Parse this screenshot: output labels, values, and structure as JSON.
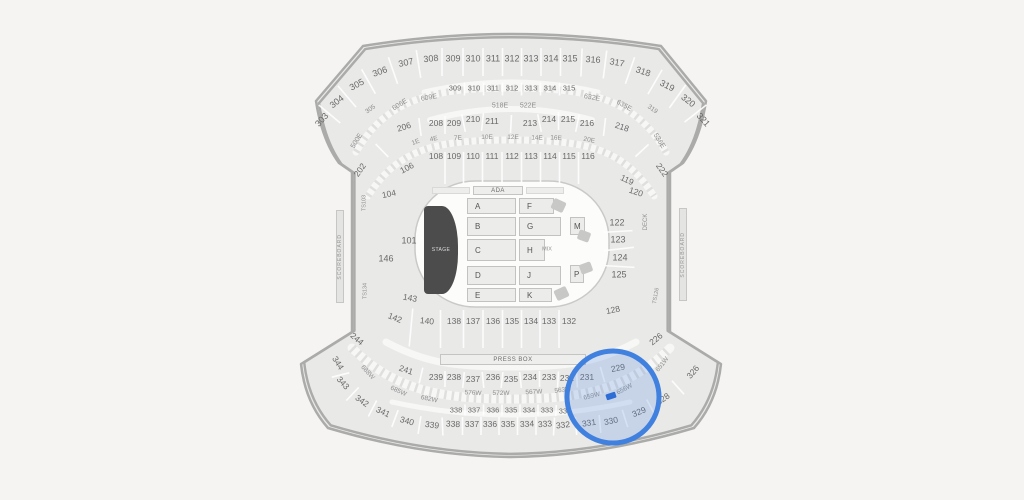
{
  "colors": {
    "background": "#f5f4f2",
    "section_fill": "#e9e9e8",
    "outline": "#ababa9",
    "walkway": "#f7f7f5",
    "label": "#696969",
    "label_dim": "#8f8f8f",
    "field_fill": "#fcfcfb",
    "stage_fill": "#4c4c4c",
    "highlight_stroke": "#4080df",
    "highlight_fill": "rgba(77,131,222,0.22)",
    "marker_fill": "#2e6cd6"
  },
  "map": {
    "stage_label": "STAGE",
    "press_box_label": "PRESS BOX",
    "ada_label": "ADA",
    "scoreboard_label": "SCOREBOARD",
    "floor": {
      "A": "A",
      "B": "B",
      "C": "C",
      "D": "D",
      "E": "E",
      "F": "F",
      "G": "G",
      "H": "H",
      "J": "J",
      "K": "K",
      "M": "M",
      "P": "P"
    },
    "labels": [
      {
        "t": "303",
        "x": 322,
        "y": 120,
        "r": -48,
        "s": 9,
        "row": "o3t"
      },
      {
        "t": "304",
        "x": 337,
        "y": 102,
        "r": -38,
        "s": 9,
        "row": "o3t"
      },
      {
        "t": "305",
        "x": 357,
        "y": 85,
        "r": -28,
        "s": 9,
        "row": "o3t"
      },
      {
        "t": "306",
        "x": 380,
        "y": 72,
        "r": -20,
        "s": 9,
        "row": "o3t"
      },
      {
        "t": "307",
        "x": 406,
        "y": 63,
        "r": -12,
        "s": 9,
        "row": "o3t"
      },
      {
        "t": "308",
        "x": 431,
        "y": 59,
        "r": -6,
        "s": 9,
        "row": "o3t"
      },
      {
        "t": "309",
        "x": 453,
        "y": 59,
        "s": 9,
        "row": "o3t"
      },
      {
        "t": "310",
        "x": 473,
        "y": 59,
        "s": 9,
        "row": "o3t"
      },
      {
        "t": "311",
        "x": 493,
        "y": 59,
        "s": 9,
        "row": "o3t"
      },
      {
        "t": "312",
        "x": 512,
        "y": 59,
        "s": 9,
        "row": "o3t"
      },
      {
        "t": "313",
        "x": 531,
        "y": 59,
        "s": 9,
        "row": "o3t"
      },
      {
        "t": "314",
        "x": 551,
        "y": 59,
        "s": 9,
        "row": "o3t"
      },
      {
        "t": "315",
        "x": 570,
        "y": 59,
        "s": 9,
        "row": "o3t"
      },
      {
        "t": "316",
        "x": 593,
        "y": 60,
        "r": 4,
        "s": 9,
        "row": "o3t"
      },
      {
        "t": "317",
        "x": 617,
        "y": 63,
        "r": 10,
        "s": 9,
        "row": "o3t"
      },
      {
        "t": "318",
        "x": 643,
        "y": 72,
        "r": 18,
        "s": 9,
        "row": "o3t"
      },
      {
        "t": "319",
        "x": 667,
        "y": 86,
        "r": 27,
        "s": 9,
        "row": "o3t"
      },
      {
        "t": "320",
        "x": 688,
        "y": 101,
        "r": 38,
        "s": 9,
        "row": "o3t"
      },
      {
        "t": "321",
        "x": 703,
        "y": 120,
        "r": 48,
        "s": 9,
        "row": "o3t"
      },
      {
        "t": "309",
        "x": 455,
        "y": 88,
        "s": 7.5,
        "row": "i3t"
      },
      {
        "t": "310",
        "x": 474,
        "y": 88,
        "s": 7.5,
        "row": "i3t"
      },
      {
        "t": "311",
        "x": 493,
        "y": 88,
        "s": 7.5,
        "row": "i3t"
      },
      {
        "t": "312",
        "x": 512,
        "y": 88,
        "s": 7.5,
        "row": "i3t"
      },
      {
        "t": "313",
        "x": 531,
        "y": 88,
        "s": 7.5,
        "row": "i3t"
      },
      {
        "t": "314",
        "x": 550,
        "y": 88,
        "s": 7.5,
        "row": "i3t"
      },
      {
        "t": "315",
        "x": 569,
        "y": 88,
        "s": 7.5,
        "row": "i3t"
      },
      {
        "t": "606E",
        "x": 400,
        "y": 105,
        "r": -32,
        "s": 7,
        "c": "d"
      },
      {
        "t": "609E",
        "x": 429,
        "y": 98,
        "r": -10,
        "s": 7,
        "c": "d"
      },
      {
        "t": "518E",
        "x": 500,
        "y": 106,
        "s": 7,
        "c": "d"
      },
      {
        "t": "522E",
        "x": 528,
        "y": 106,
        "s": 7,
        "c": "d"
      },
      {
        "t": "632E",
        "x": 592,
        "y": 98,
        "r": 10,
        "s": 7,
        "c": "d"
      },
      {
        "t": "635E",
        "x": 624,
        "y": 106,
        "r": 30,
        "s": 7,
        "c": "d"
      },
      {
        "t": "500E",
        "x": 357,
        "y": 141,
        "r": -58,
        "s": 7,
        "c": "d"
      },
      {
        "t": "536E",
        "x": 659,
        "y": 141,
        "r": 58,
        "s": 7,
        "c": "d"
      },
      {
        "t": "305",
        "x": 371,
        "y": 110,
        "r": -35,
        "s": 6.5,
        "c": "d"
      },
      {
        "t": "319",
        "x": 652,
        "y": 110,
        "r": 35,
        "s": 6.5,
        "c": "d"
      },
      {
        "t": "202",
        "x": 360,
        "y": 170,
        "r": -55,
        "row": "2t"
      },
      {
        "t": "206",
        "x": 404,
        "y": 127,
        "r": -18,
        "row": "2t"
      },
      {
        "t": "208",
        "x": 436,
        "y": 123,
        "row": "2t"
      },
      {
        "t": "209",
        "x": 454,
        "y": 123,
        "row": "2t"
      },
      {
        "t": "210",
        "x": 473,
        "y": 119,
        "row": "2t"
      },
      {
        "t": "211",
        "x": 492,
        "y": 121,
        "row": "2t"
      },
      {
        "t": "213",
        "x": 530,
        "y": 123,
        "row": "2t"
      },
      {
        "t": "214",
        "x": 549,
        "y": 119,
        "row": "2t"
      },
      {
        "t": "215",
        "x": 568,
        "y": 119,
        "row": "2t"
      },
      {
        "t": "216",
        "x": 587,
        "y": 123,
        "row": "2t"
      },
      {
        "t": "218",
        "x": 622,
        "y": 127,
        "r": 18,
        "row": "2t"
      },
      {
        "t": "222",
        "x": 662,
        "y": 170,
        "r": 55,
        "row": "2t"
      },
      {
        "t": "1E",
        "x": 416,
        "y": 143,
        "r": -22,
        "s": 6.5,
        "c": "d"
      },
      {
        "t": "4E",
        "x": 434,
        "y": 140,
        "r": -12,
        "s": 6.5,
        "c": "d"
      },
      {
        "t": "7E",
        "x": 458,
        "y": 139,
        "r": -4,
        "s": 6.5,
        "c": "d"
      },
      {
        "t": "10E",
        "x": 487,
        "y": 138,
        "s": 6.5,
        "c": "d"
      },
      {
        "t": "12E",
        "x": 513,
        "y": 138,
        "s": 6.5,
        "c": "d"
      },
      {
        "t": "14E",
        "x": 537,
        "y": 139,
        "r": 2,
        "s": 6.5,
        "c": "d"
      },
      {
        "t": "16E",
        "x": 556,
        "y": 139,
        "r": 4,
        "s": 6.5,
        "c": "d"
      },
      {
        "t": "20E",
        "x": 589,
        "y": 141,
        "r": 12,
        "s": 6.5,
        "c": "d"
      },
      {
        "t": "108",
        "x": 436,
        "y": 156,
        "row": "1t"
      },
      {
        "t": "109",
        "x": 454,
        "y": 156,
        "row": "1t"
      },
      {
        "t": "110",
        "x": 473,
        "y": 156,
        "row": "1t"
      },
      {
        "t": "111",
        "x": 492,
        "y": 156,
        "row": "1t"
      },
      {
        "t": "112",
        "x": 512,
        "y": 156,
        "row": "1t"
      },
      {
        "t": "113",
        "x": 531,
        "y": 156,
        "row": "1t"
      },
      {
        "t": "114",
        "x": 550,
        "y": 156,
        "row": "1t"
      },
      {
        "t": "115",
        "x": 569,
        "y": 156,
        "row": "1t"
      },
      {
        "t": "116",
        "x": 588,
        "y": 156,
        "row": "1t"
      },
      {
        "t": "106",
        "x": 407,
        "y": 168,
        "r": -28
      },
      {
        "t": "104",
        "x": 389,
        "y": 194,
        "r": -12
      },
      {
        "t": "101",
        "x": 409,
        "y": 241,
        "s": 9
      },
      {
        "t": "146",
        "x": 386,
        "y": 259,
        "s": 9
      },
      {
        "t": "143",
        "x": 410,
        "y": 298,
        "r": 10
      },
      {
        "t": "TS103",
        "x": 365,
        "y": 203,
        "r": -90,
        "s": 5.5,
        "c": "d"
      },
      {
        "t": "TS134",
        "x": 366,
        "y": 291,
        "r": -90,
        "s": 5.5,
        "c": "d"
      },
      {
        "t": "119",
        "x": 627,
        "y": 180,
        "r": 25
      },
      {
        "t": "120",
        "x": 636,
        "y": 192,
        "r": 18
      },
      {
        "t": "122",
        "x": 617,
        "y": 223,
        "s": 9,
        "row": "1r"
      },
      {
        "t": "123",
        "x": 618,
        "y": 240,
        "s": 9,
        "row": "1r"
      },
      {
        "t": "124",
        "x": 620,
        "y": 258,
        "s": 9,
        "row": "1r"
      },
      {
        "t": "125",
        "x": 619,
        "y": 275,
        "s": 9,
        "row": "1r"
      },
      {
        "t": "128",
        "x": 613,
        "y": 310,
        "r": -12
      },
      {
        "t": "DECK",
        "x": 646,
        "y": 222,
        "r": -90,
        "s": 6,
        "c": "d"
      },
      {
        "t": "TS126",
        "x": 657,
        "y": 296,
        "r": -80,
        "s": 5.5,
        "c": "d"
      },
      {
        "t": "MIX",
        "x": 547,
        "y": 250,
        "s": 5.5,
        "c": "d"
      },
      {
        "t": "142",
        "x": 395,
        "y": 318,
        "r": 22,
        "row": "1b"
      },
      {
        "t": "140",
        "x": 427,
        "y": 321,
        "r": 6,
        "row": "1b"
      },
      {
        "t": "138",
        "x": 454,
        "y": 321,
        "row": "1b"
      },
      {
        "t": "137",
        "x": 473,
        "y": 321,
        "row": "1b"
      },
      {
        "t": "136",
        "x": 493,
        "y": 321,
        "row": "1b"
      },
      {
        "t": "135",
        "x": 512,
        "y": 321,
        "row": "1b"
      },
      {
        "t": "134",
        "x": 531,
        "y": 321,
        "row": "1b"
      },
      {
        "t": "133",
        "x": 549,
        "y": 321,
        "row": "1b"
      },
      {
        "t": "132",
        "x": 569,
        "y": 321,
        "row": "1b"
      },
      {
        "t": "244",
        "x": 357,
        "y": 339,
        "r": 40
      },
      {
        "t": "226",
        "x": 656,
        "y": 339,
        "r": -40
      },
      {
        "t": "241",
        "x": 406,
        "y": 370,
        "r": 18,
        "row": "2b"
      },
      {
        "t": "239",
        "x": 436,
        "y": 377,
        "row": "2b"
      },
      {
        "t": "238",
        "x": 454,
        "y": 377,
        "row": "2b"
      },
      {
        "t": "237",
        "x": 473,
        "y": 379,
        "row": "2b"
      },
      {
        "t": "236",
        "x": 493,
        "y": 377,
        "row": "2b"
      },
      {
        "t": "235",
        "x": 511,
        "y": 379,
        "row": "2b"
      },
      {
        "t": "234",
        "x": 530,
        "y": 377,
        "row": "2b"
      },
      {
        "t": "233",
        "x": 549,
        "y": 377,
        "row": "2b"
      },
      {
        "t": "232",
        "x": 567,
        "y": 378,
        "row": "2b"
      },
      {
        "t": "231",
        "x": 587,
        "y": 377,
        "row": "2b"
      },
      {
        "t": "229",
        "x": 618,
        "y": 368,
        "r": -12,
        "row": "2b"
      },
      {
        "t": "688W",
        "x": 367,
        "y": 373,
        "r": 48,
        "s": 6.5,
        "c": "d"
      },
      {
        "t": "685W",
        "x": 398,
        "y": 392,
        "r": 25,
        "s": 6.5,
        "c": "d"
      },
      {
        "t": "682W",
        "x": 429,
        "y": 400,
        "r": 12,
        "s": 6.5,
        "c": "d"
      },
      {
        "t": "576W",
        "x": 473,
        "y": 394,
        "r": 3,
        "s": 6.5,
        "c": "d"
      },
      {
        "t": "572W",
        "x": 501,
        "y": 394,
        "s": 6.5,
        "c": "d"
      },
      {
        "t": "567W",
        "x": 534,
        "y": 393,
        "r": -3,
        "s": 6.5,
        "c": "d"
      },
      {
        "t": "563W",
        "x": 563,
        "y": 391,
        "r": -8,
        "s": 6.5,
        "c": "d"
      },
      {
        "t": "659W",
        "x": 592,
        "y": 397,
        "r": -14,
        "s": 6.5,
        "c": "d"
      },
      {
        "t": "656W",
        "x": 625,
        "y": 390,
        "r": -28,
        "s": 6.5,
        "c": "d"
      },
      {
        "t": "651W",
        "x": 663,
        "y": 365,
        "r": -52,
        "s": 6.5,
        "c": "d"
      },
      {
        "t": "338",
        "x": 456,
        "y": 410,
        "s": 7.5,
        "row": "3ib"
      },
      {
        "t": "337",
        "x": 474,
        "y": 410,
        "s": 7.5,
        "row": "3ib"
      },
      {
        "t": "336",
        "x": 493,
        "y": 410,
        "s": 7.5,
        "row": "3ib"
      },
      {
        "t": "335",
        "x": 511,
        "y": 410,
        "s": 7.5,
        "row": "3ib"
      },
      {
        "t": "334",
        "x": 529,
        "y": 410,
        "s": 7.5,
        "row": "3ib"
      },
      {
        "t": "333",
        "x": 547,
        "y": 410,
        "s": 7.5,
        "row": "3ib"
      },
      {
        "t": "332",
        "x": 565,
        "y": 411,
        "s": 7.5,
        "row": "3ib"
      },
      {
        "t": "344",
        "x": 338,
        "y": 363,
        "r": 58,
        "row": "o3b"
      },
      {
        "t": "343",
        "x": 343,
        "y": 383,
        "r": 48,
        "row": "o3b"
      },
      {
        "t": "342",
        "x": 362,
        "y": 401,
        "r": 35,
        "row": "o3b"
      },
      {
        "t": "341",
        "x": 383,
        "y": 412,
        "r": 25,
        "row": "o3b"
      },
      {
        "t": "340",
        "x": 407,
        "y": 421,
        "r": 16,
        "row": "o3b"
      },
      {
        "t": "339",
        "x": 432,
        "y": 425,
        "r": 8,
        "row": "o3b"
      },
      {
        "t": "338",
        "x": 453,
        "y": 424,
        "r": 3,
        "row": "o3b"
      },
      {
        "t": "337",
        "x": 472,
        "y": 424,
        "row": "o3b"
      },
      {
        "t": "336",
        "x": 490,
        "y": 424,
        "row": "o3b"
      },
      {
        "t": "335",
        "x": 508,
        "y": 424,
        "row": "o3b"
      },
      {
        "t": "334",
        "x": 527,
        "y": 424,
        "r": -2,
        "row": "o3b"
      },
      {
        "t": "333",
        "x": 545,
        "y": 424,
        "r": -4,
        "row": "o3b"
      },
      {
        "t": "332",
        "x": 563,
        "y": 425,
        "r": -6,
        "row": "o3b"
      },
      {
        "t": "331",
        "x": 589,
        "y": 423,
        "r": -8,
        "row": "o3b"
      },
      {
        "t": "330",
        "x": 611,
        "y": 421,
        "r": -12,
        "row": "o3b"
      },
      {
        "t": "329",
        "x": 639,
        "y": 412,
        "r": -22,
        "row": "o3b"
      },
      {
        "t": "328",
        "x": 663,
        "y": 399,
        "r": -35,
        "row": "o3b"
      },
      {
        "t": "326",
        "x": 693,
        "y": 372,
        "r": -50,
        "row": "o3b"
      }
    ]
  },
  "selection": {
    "highlight": {
      "cx": 613,
      "cy": 397,
      "r": 46
    },
    "marker": {
      "x": 606,
      "y": 393,
      "w": 10,
      "h": 6,
      "rot": -18
    }
  }
}
